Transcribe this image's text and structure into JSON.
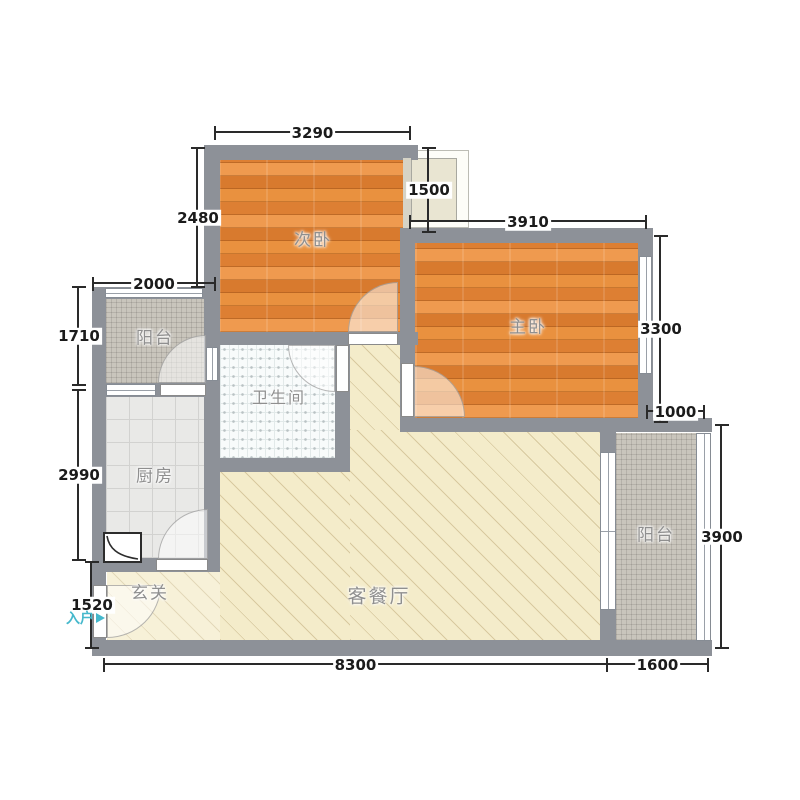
{
  "floorplan": {
    "rooms": [
      {
        "id": "secondary-bedroom",
        "label": "次卧"
      },
      {
        "id": "master-bedroom",
        "label": "主卧"
      },
      {
        "id": "balcony-left",
        "label": "阳台"
      },
      {
        "id": "bathroom",
        "label": "卫生间"
      },
      {
        "id": "kitchen",
        "label": "厨房"
      },
      {
        "id": "entry-hall",
        "label": "玄关"
      },
      {
        "id": "living-dining",
        "label": "客餐厅"
      },
      {
        "id": "balcony-right",
        "label": "阳台"
      }
    ],
    "dimensions": [
      {
        "id": "secondary-bedroom-width",
        "value": "3290"
      },
      {
        "id": "flue-recess",
        "value": "1500"
      },
      {
        "id": "master-bedroom-width",
        "value": "3910"
      },
      {
        "id": "secondary-bedroom-depth",
        "value": "2480"
      },
      {
        "id": "balcony-left-width",
        "value": "2000"
      },
      {
        "id": "balcony-left-depth",
        "value": "1710"
      },
      {
        "id": "kitchen-depth",
        "value": "2990"
      },
      {
        "id": "entry-depth",
        "value": "1520"
      },
      {
        "id": "master-bedroom-depth",
        "value": "3300"
      },
      {
        "id": "overhang-width",
        "value": "1000"
      },
      {
        "id": "balcony-right-depth",
        "value": "3900"
      },
      {
        "id": "overall-bottom-width",
        "value": "8300"
      },
      {
        "id": "balcony-right-width",
        "value": "1600"
      }
    ],
    "entry_label": "入户",
    "colors": {
      "wall": "#8d9198",
      "wood": "#e2873e",
      "living": "#f4ecca",
      "kitchen": "#e9e9e7",
      "bathroom": "#f8fbfb",
      "balcony": "#c9c5bc",
      "entry": "#45b8cc",
      "dim": "#1b1b1b",
      "label": "#8f8f8f"
    }
  }
}
